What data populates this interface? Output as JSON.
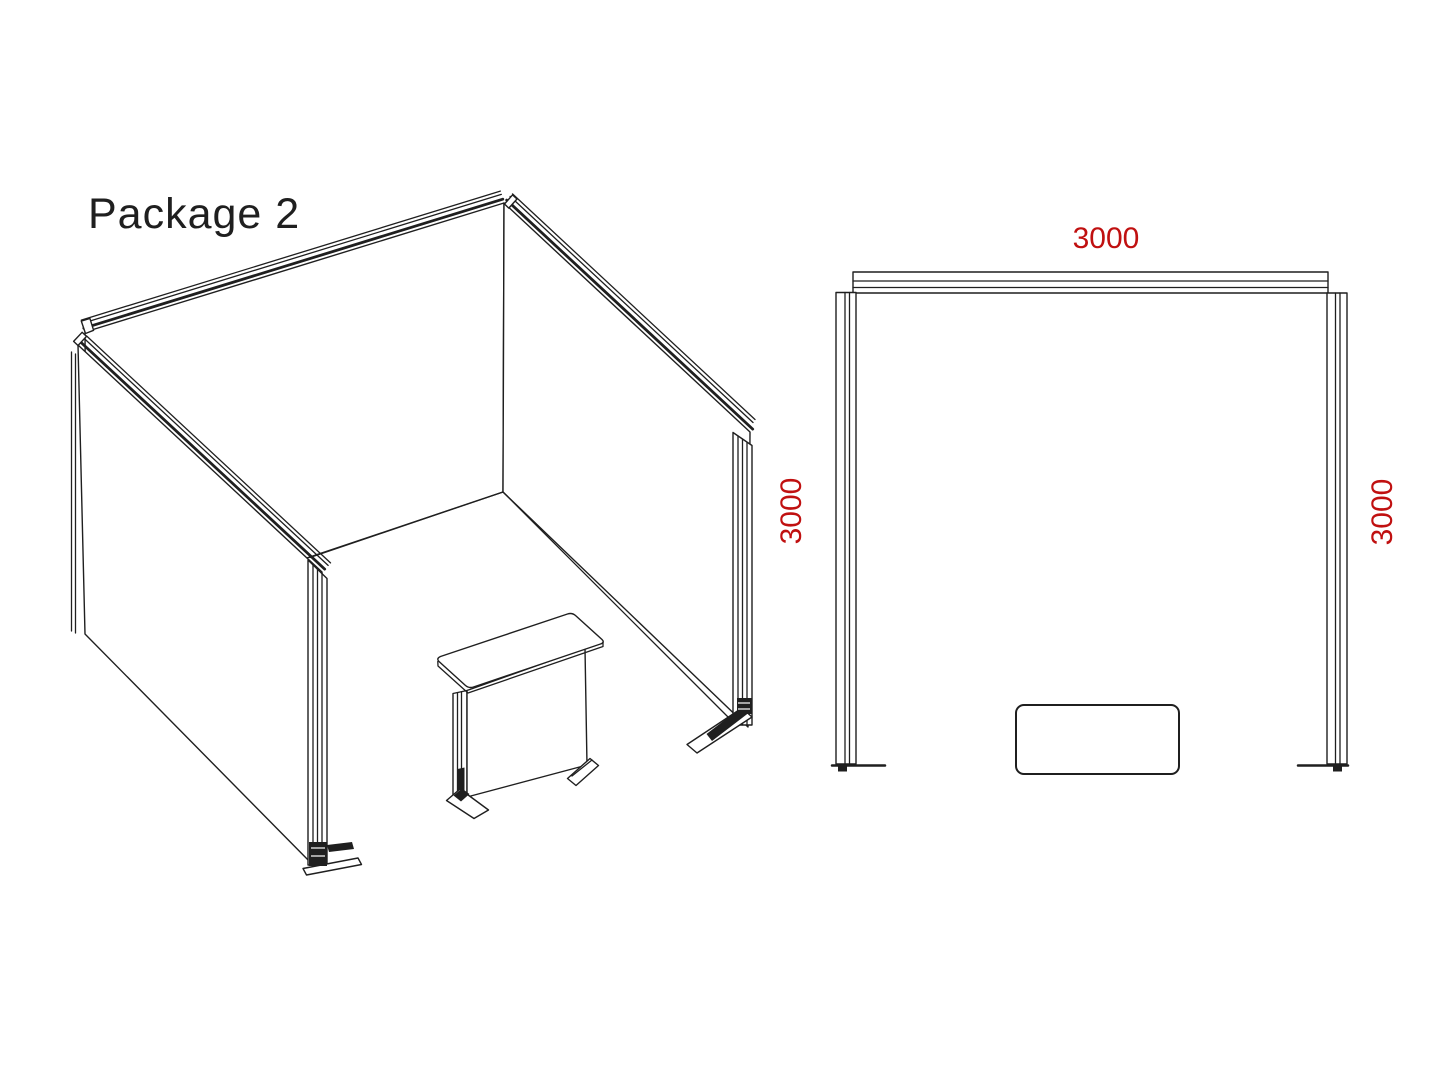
{
  "title": "Package 2",
  "colors": {
    "line": "#1f1f1f",
    "dimension": "#c01010",
    "background": "#ffffff"
  },
  "isometric_view": {
    "name": "exhibition-booth-isometric-drawing",
    "parts": [
      "back-wall-panel",
      "left-wall-panel",
      "right-wall-panel",
      "counter-table",
      "base-feet"
    ]
  },
  "plan_view": {
    "name": "booth-floor-plan",
    "dim_top": "3000",
    "dim_left": "3000",
    "dim_right": "3000",
    "parts": [
      "back-wall",
      "left-wall",
      "right-wall",
      "counter"
    ]
  }
}
